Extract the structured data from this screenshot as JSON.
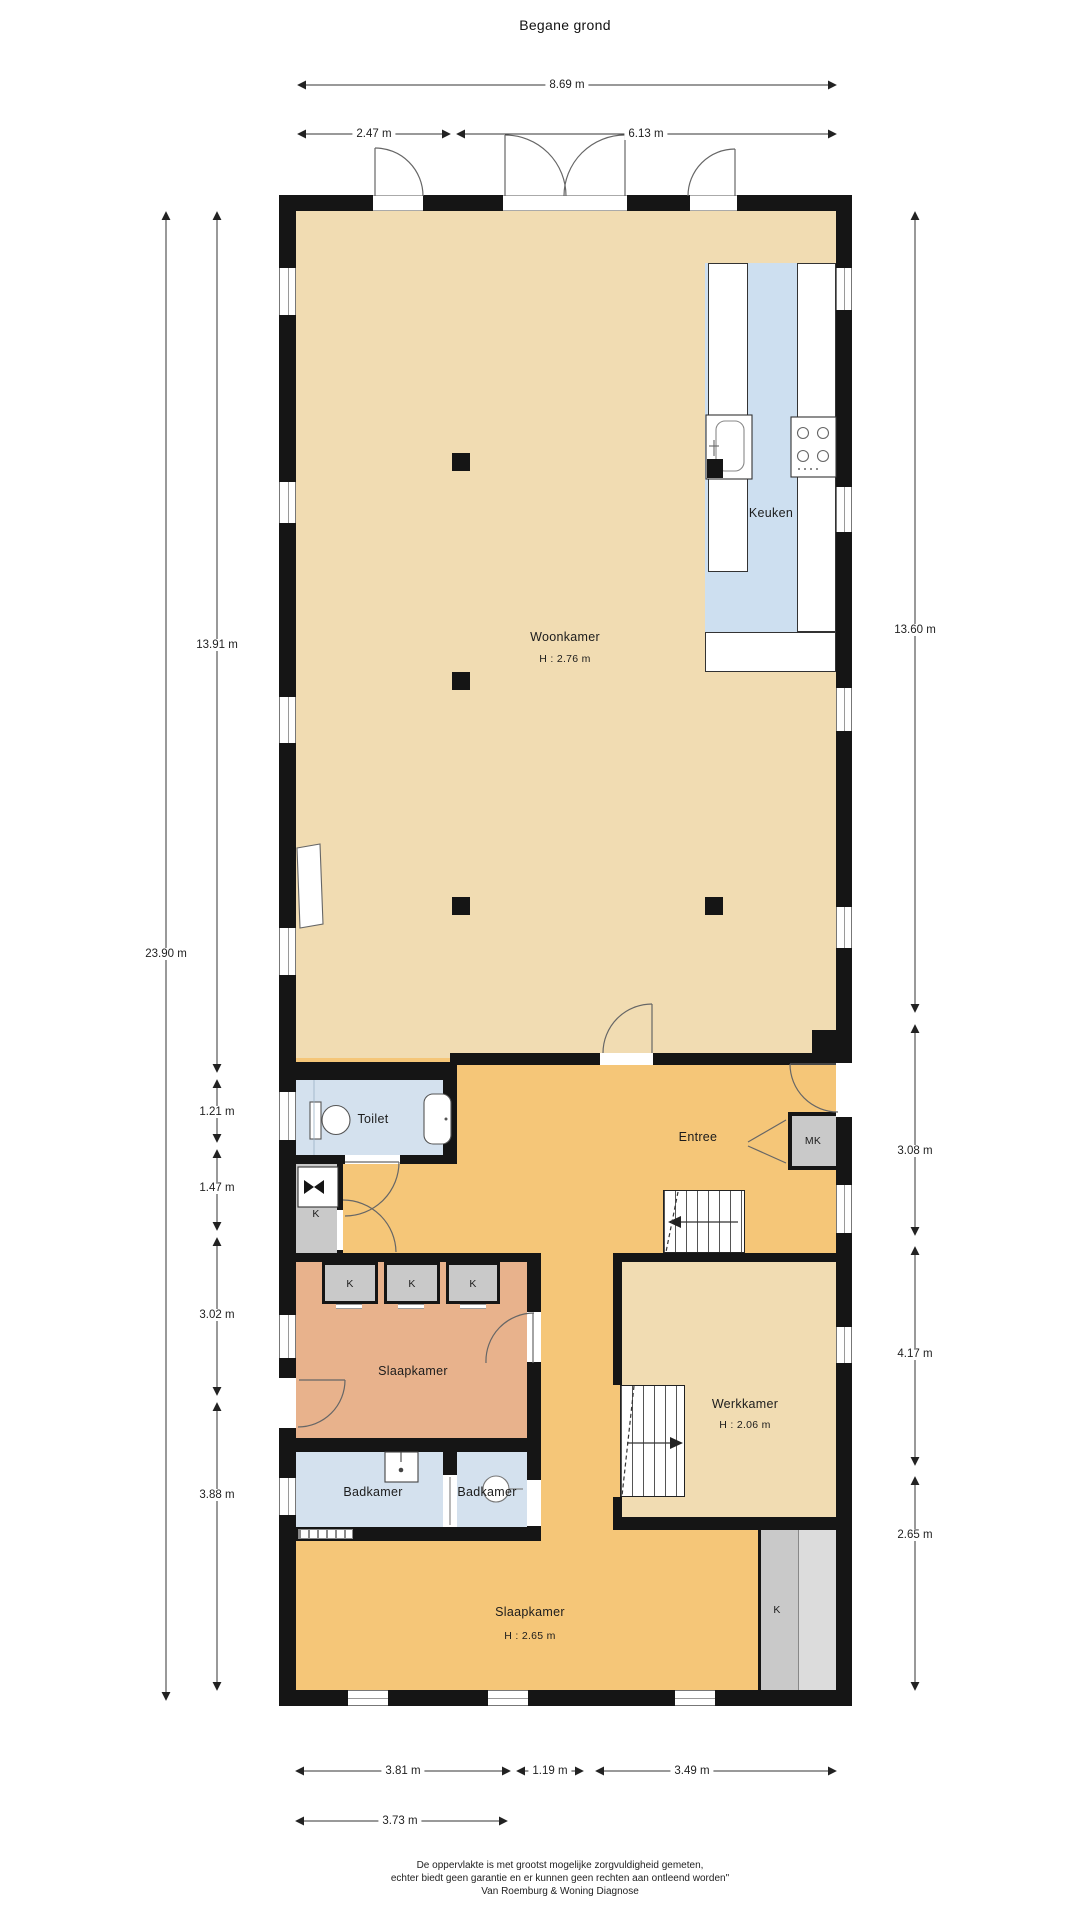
{
  "title": "Begane grond",
  "rooms": {
    "woonkamer": {
      "label": "Woonkamer",
      "height": "H : 2.76 m"
    },
    "keuken": {
      "label": "Keuken"
    },
    "toilet": {
      "label": "Toilet"
    },
    "entree": {
      "label": "Entree"
    },
    "slaapkamer1": {
      "label": "Slaapkamer"
    },
    "badkamer1": {
      "label": "Badkamer"
    },
    "badkamer2": {
      "label": "Badkamer"
    },
    "werkkamer": {
      "label": "Werkkamer",
      "height": "H : 2.06 m"
    },
    "slaapkamer2": {
      "label": "Slaapkamer",
      "height": "H : 2.65 m"
    },
    "mk": {
      "label": "MK"
    },
    "k": {
      "label": "K"
    }
  },
  "dimensions": {
    "top_total": "8.69 m",
    "top_left": "2.47 m",
    "top_right": "6.13 m",
    "left_inner": "13.91 m",
    "left_total": "23.90 m",
    "left_1": "1.21 m",
    "left_2": "1.47 m",
    "left_3": "3.02 m",
    "left_4": "3.88 m",
    "right_1": "13.60 m",
    "right_2": "3.08 m",
    "right_3": "4.17 m",
    "right_4": "2.65 m",
    "bottom_1": "3.81 m",
    "bottom_2": "1.19 m",
    "bottom_3": "3.49 m",
    "bottom_4": "3.73 m"
  },
  "footer": [
    "De oppervlakte is met grootst mogelijke zorgvuldigheid gemeten,",
    "echter biedt geen garantie en er kunnen geen rechten aan ontleend worden\"",
    "Van Roemburg & Woning Diagnose"
  ],
  "colors": {
    "wall": "#151515",
    "living": "#f1dcb2",
    "hall": "#f5c678",
    "bedroom_mid": "#e8b28c",
    "bathroom": "#d4e1ee",
    "kitchen": "#cddff0",
    "closet": "#c9c9c9"
  }
}
